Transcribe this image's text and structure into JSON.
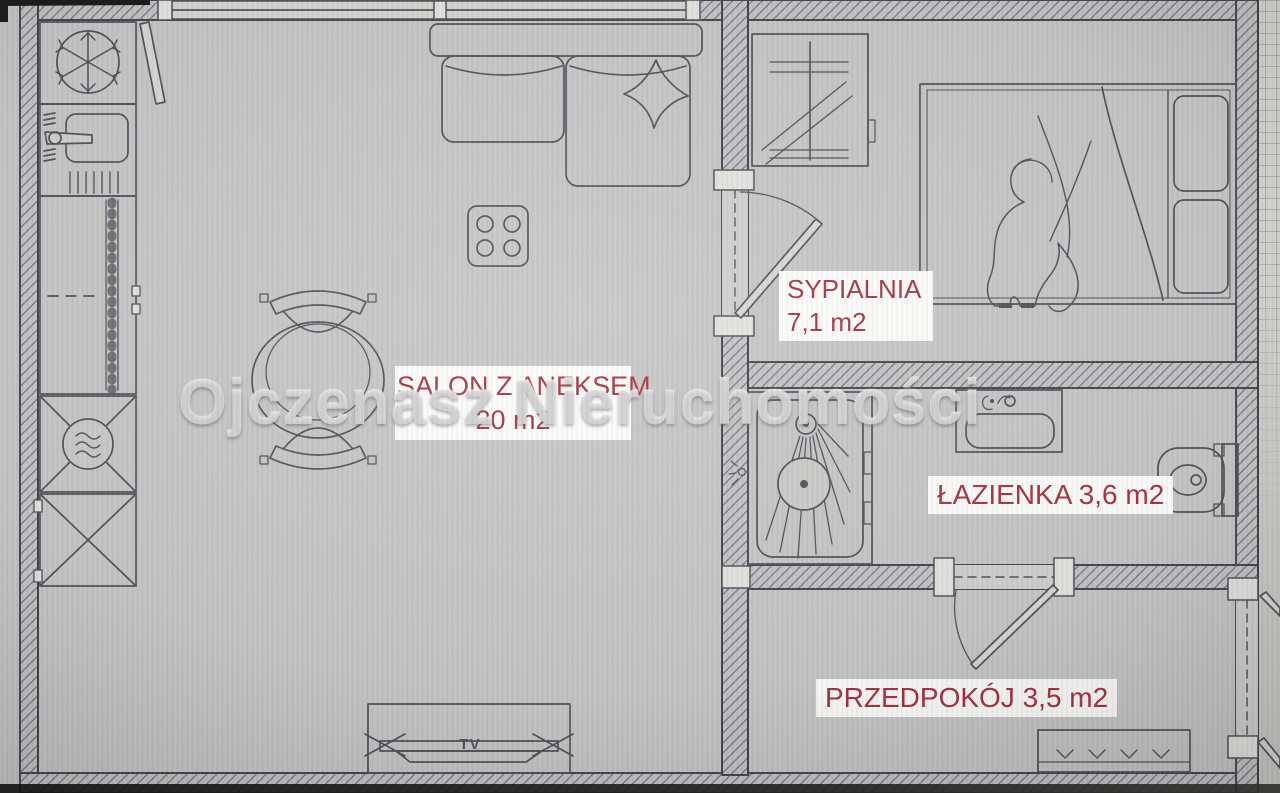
{
  "document": {
    "type": "apartment-floor-plan"
  },
  "watermark": {
    "text": "Ojczenasz Nieruchomości"
  },
  "rooms": {
    "salon": {
      "name": "SALON Z ANEKSEM",
      "area": "20 m2"
    },
    "sypialnia": {
      "name": "SYPIALNIA",
      "area": "7,1 m2"
    },
    "lazienka": {
      "name": "ŁAZIENKA",
      "area": "3,6 m2"
    },
    "przedpokoj": {
      "name": "PRZEDPOKÓJ",
      "area": "3,5 m2"
    }
  },
  "furniture": {
    "tv_label": "TV"
  },
  "colors": {
    "paper": "#c6c6c6",
    "line": "#52525a",
    "label_text": "#a83340",
    "label_bg": "#fcfcfa",
    "watermark": "#dbdbdb"
  }
}
